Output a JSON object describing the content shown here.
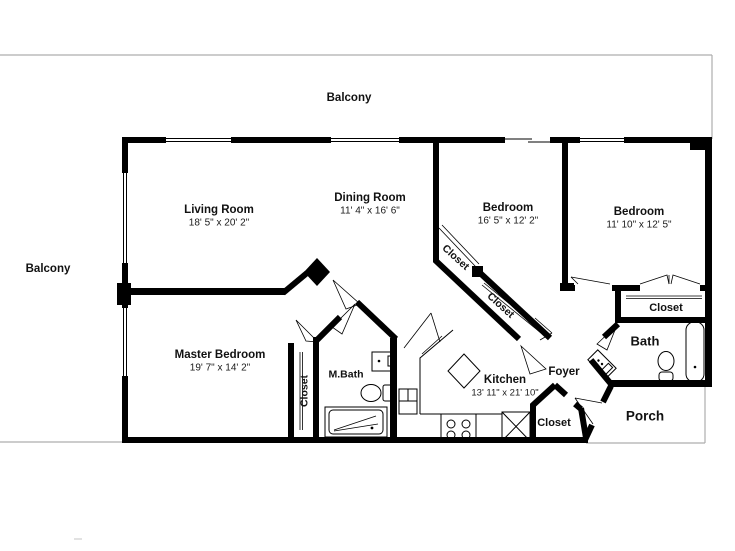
{
  "plan": {
    "outdoor": {
      "balcony_top": "Balcony",
      "balcony_left": "Balcony",
      "porch": "Porch"
    },
    "rooms": {
      "living_room": {
        "name": "Living Room",
        "dimensions": "18' 5\" x 20' 2\""
      },
      "dining_room": {
        "name": "Dining Room",
        "dimensions": "11' 4\" x 16' 6\""
      },
      "bedroom_center": {
        "name": "Bedroom",
        "dimensions": "16' 5\" x 12' 2\""
      },
      "bedroom_right": {
        "name": "Bedroom",
        "dimensions": "11' 10\" x 12' 5\""
      },
      "master_bedroom": {
        "name": "Master Bedroom",
        "dimensions": "19' 7\" x 14' 2\""
      },
      "kitchen": {
        "name": "Kitchen",
        "dimensions": "13' 11\" x 21' 10\""
      },
      "master_bath": {
        "name": "M.Bath"
      },
      "bath": {
        "name": "Bath"
      },
      "foyer": {
        "name": "Foyer"
      }
    },
    "closets": {
      "master_closet": "Closet",
      "bedroom_closet_upper": "Closet",
      "bedroom_closet_lower": "Closet",
      "hall_closet": "Closet",
      "entry_closet": "Closet"
    }
  }
}
